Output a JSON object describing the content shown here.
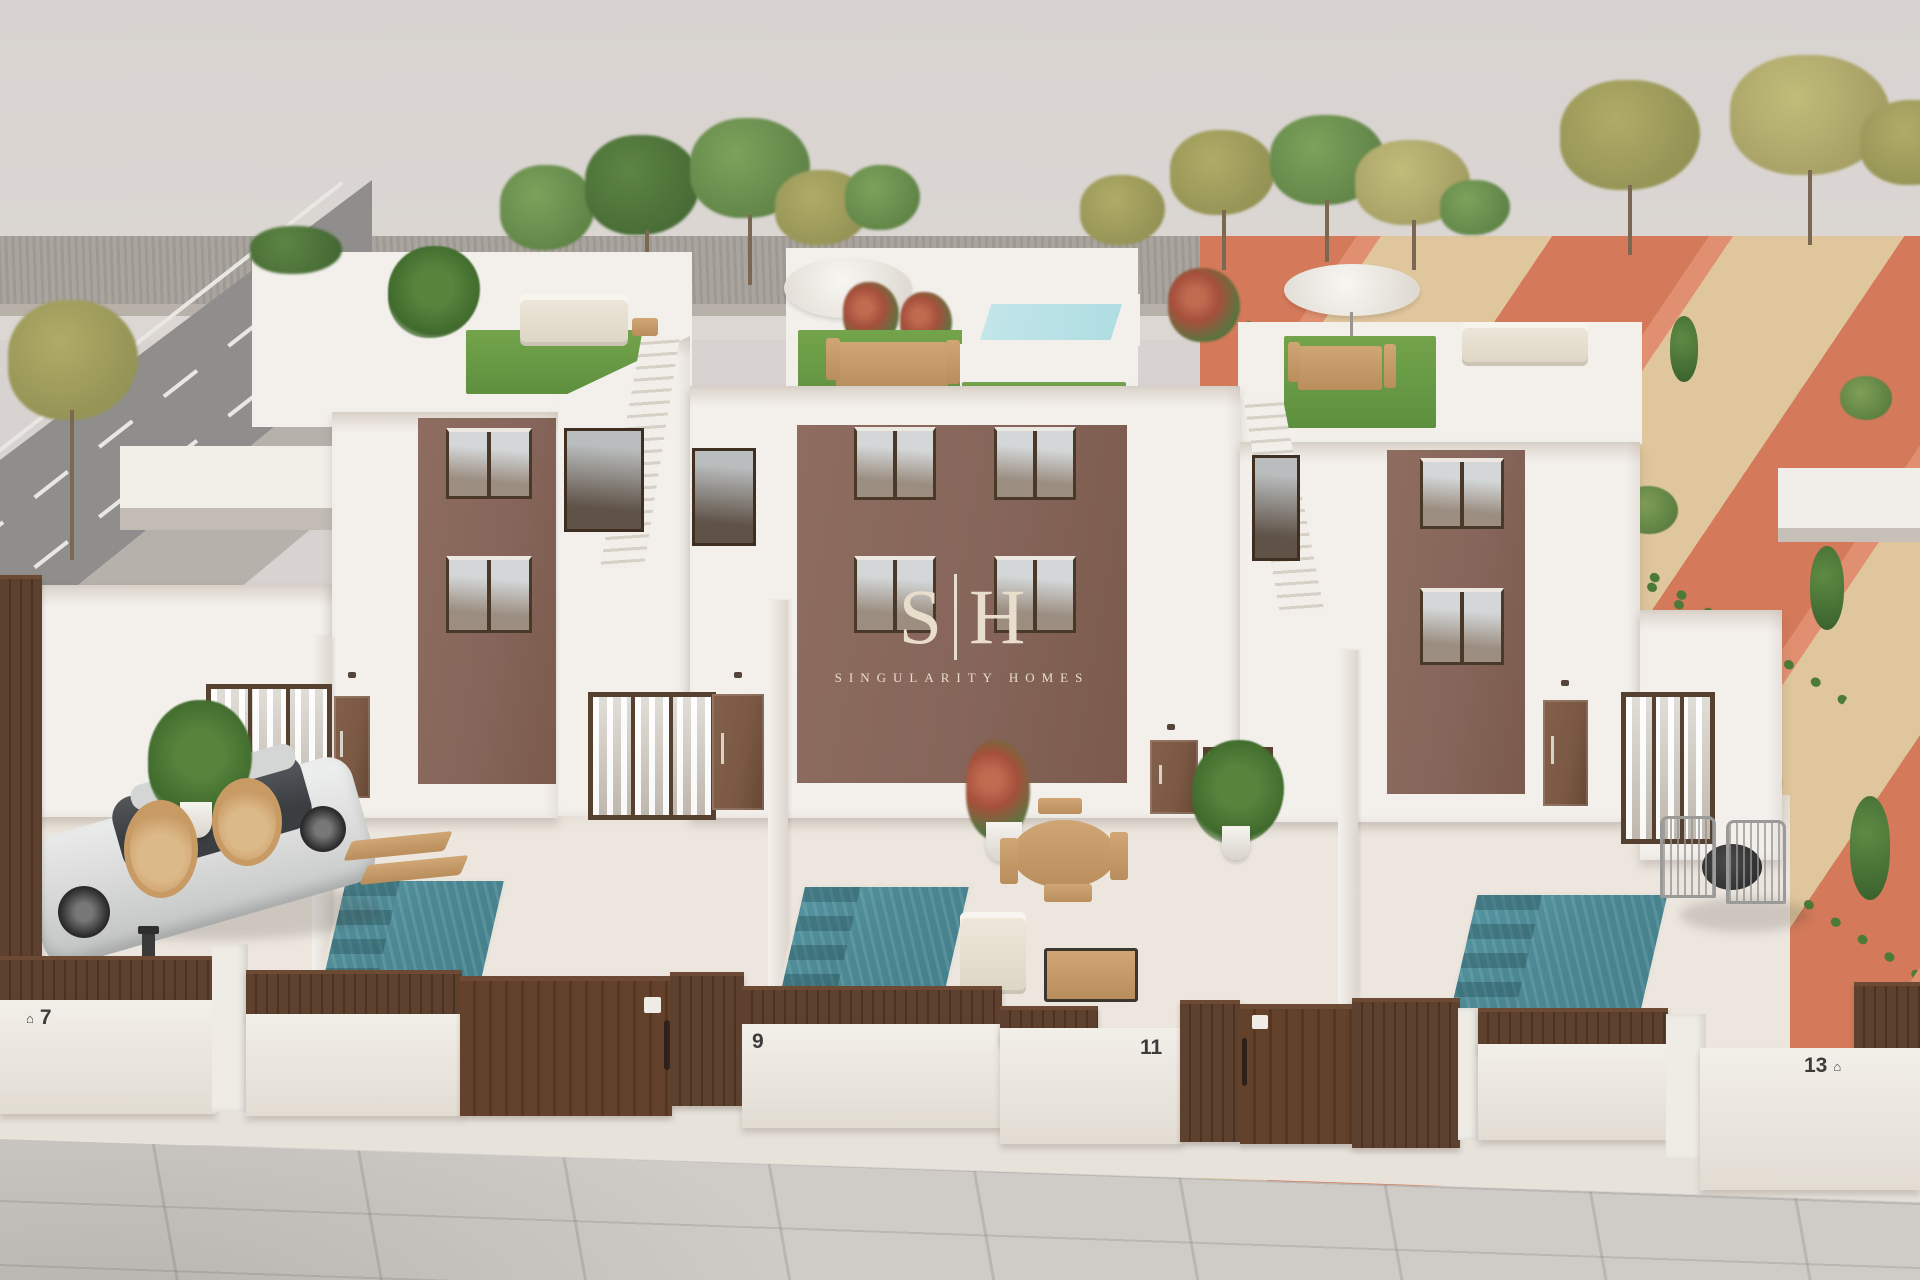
{
  "brand": {
    "logo_s": "S",
    "divider": "|",
    "logo_h": "H",
    "subtitle": "SINGULARITY HOMES"
  },
  "units": [
    {
      "number": "7"
    },
    {
      "number": "9"
    },
    {
      "number": "11"
    },
    {
      "number": "13"
    }
  ],
  "icons": {
    "address_plate": "⌂"
  },
  "theme": {
    "sky": "#d8d3d0",
    "gravel": "#a7a19a",
    "road": "#8f8e8c",
    "roadline": "#e9e7e3",
    "sidewalk": "#b6b1ab",
    "terracotta": "#d47a5a",
    "sand": "#e0c69c",
    "shrub": "#4c7a38",
    "wall": "#f3f0ec",
    "wallShade": "#ddd6cd",
    "facade": "#86655a",
    "wood": "#4a3829",
    "fence": "#5c3e2c",
    "gate": "#63412b",
    "door": "#7a5843",
    "pool": "#4c8893",
    "poolTop": "#aedde2",
    "turf": "#679b43",
    "yard": "#ece6de",
    "pave": "#cfccc8",
    "cream": "#e9ddcc",
    "number": "#3c3c3c",
    "carBody": "#dcdddc",
    "carGlass": "#3b3e41",
    "tan": "#c79c6a"
  }
}
